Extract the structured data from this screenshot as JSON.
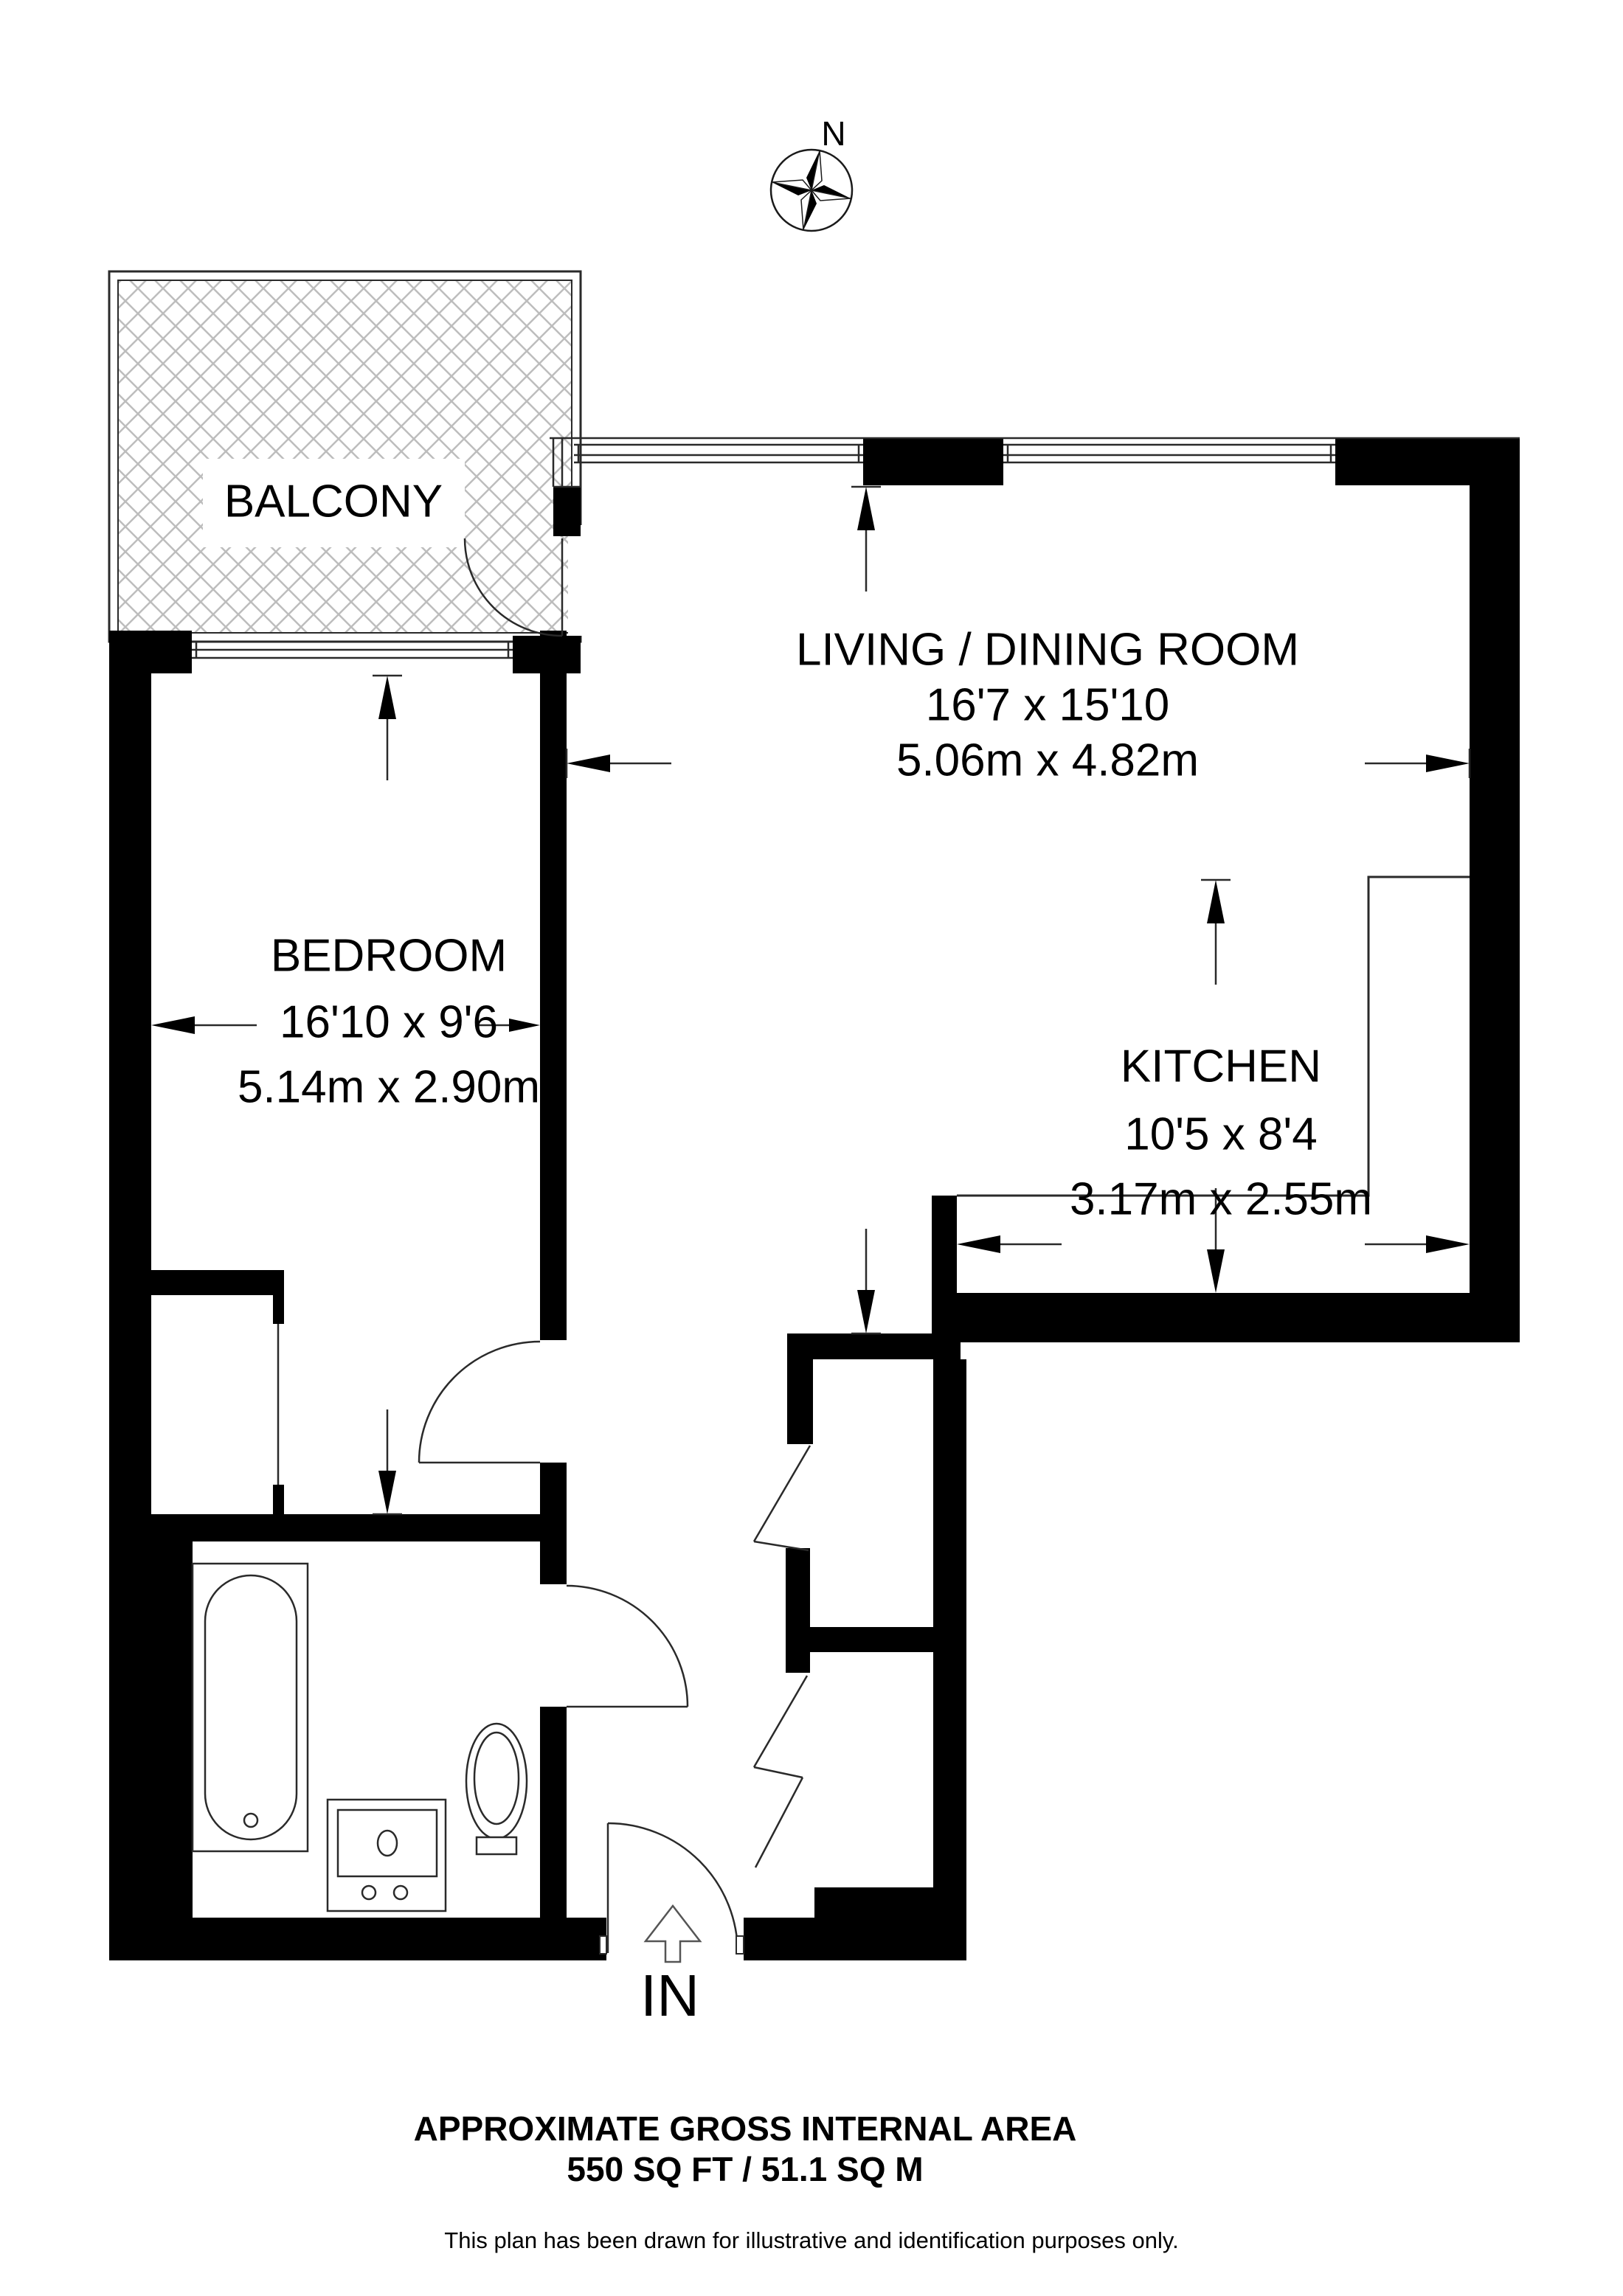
{
  "compass": {
    "north_label": "N"
  },
  "rooms": {
    "balcony": {
      "name": "BALCONY"
    },
    "living": {
      "name": "LIVING / DINING ROOM",
      "imperial": "16'7 x 15'10",
      "metric": "5.06m x 4.82m"
    },
    "bedroom": {
      "name": "BEDROOM",
      "imperial": "16'10 x 9'6",
      "metric": "5.14m x 2.90m"
    },
    "kitchen": {
      "name": "KITCHEN",
      "imperial": "10'5 x 8'4",
      "metric": "3.17m x 2.55m"
    }
  },
  "entrance": {
    "label": "IN"
  },
  "footer": {
    "title": "APPROXIMATE GROSS INTERNAL AREA",
    "area": "550 SQ FT / 51.1 SQ M",
    "disclaimer": "This plan has been drawn for illustrative and identification purposes only."
  },
  "colors": {
    "wall": "#000000",
    "line": "#2a2a2a",
    "hatch": "#bdbdbd",
    "background": "#ffffff"
  }
}
